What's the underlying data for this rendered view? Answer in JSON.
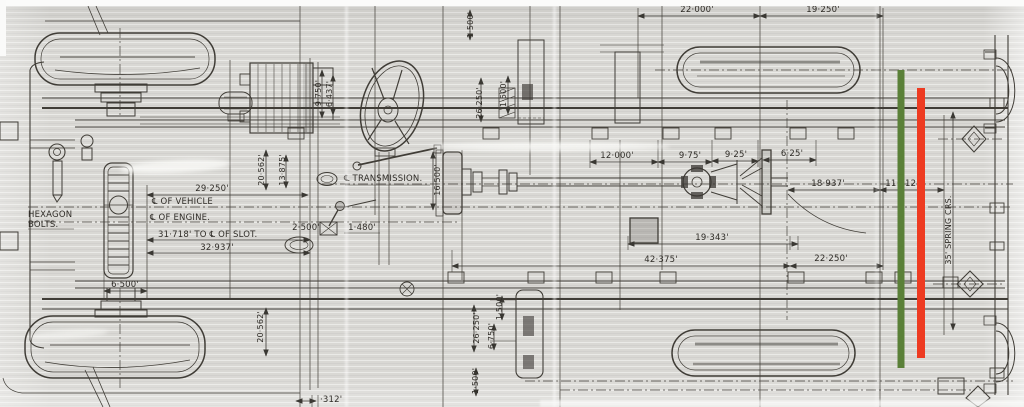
{
  "document": {
    "type": "scanned chassis blueprint, plan view",
    "colors": {
      "paper": "#d9d8d4",
      "ink": "#403d37",
      "green_line": "#5a8038",
      "red_line": "#ee3b21"
    }
  },
  "labels": {
    "hexagon_bolts_1": "HEXAGON",
    "hexagon_bolts_2": "BOLTS.",
    "dim_29_250": "29·250'",
    "cl_of_vehicle": "℄ OF VEHICLE",
    "cl_of_engine": "℄ OF ENGINE.",
    "dim_31_718": "31·718' TO ℄ OF SLOT.",
    "dim_32_937": "32·937'",
    "dim_6_500": "6·500'",
    "cl_transmission": "℄ TRANSMISSION.",
    "dim_22_000": "22·000'",
    "dim_19_250": "19·250'",
    "dim_12_000": "12·000'",
    "dim_9_75": "9·75'",
    "dim_9_25": "9·25'",
    "dim_6_25": "6·25'",
    "dim_18_937": "18·937'",
    "dim_11_312": "11·312'",
    "dim_19_343": "19·343'",
    "dim_42_375": "42·375'",
    "dim_22_250": "22·250'",
    "dim_2_500": "2·500'",
    "dim_1_480": "1·480'",
    "dim_16_500": "16·500'",
    "dim_1_500_a": "1·500'",
    "dim_26_250_a": "26·250'",
    "dim_1_500_b": "1·500'",
    "dim_20_562_a": "20·562'",
    "dim_13_875": "13·875'",
    "dim_9_750": "9·750'",
    "dim_6_437": "6·437'",
    "dim_26_250_b": "26·250'",
    "dim_1_500_c": "1·500'",
    "dim_6_750": "6·750'",
    "dim_1_500_d": "1·500'",
    "dim_20_562_b": "20·562'",
    "dim_312": "·312'",
    "spring_centers": "35' SPRING CRS."
  }
}
